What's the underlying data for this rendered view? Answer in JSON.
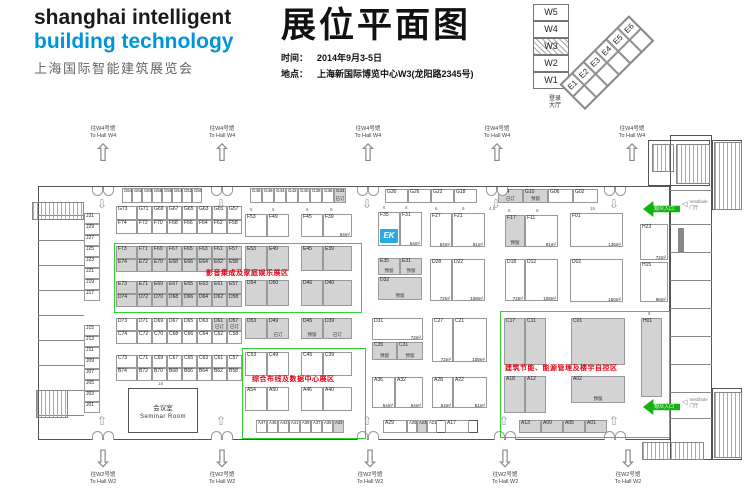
{
  "header": {
    "logo_line1": "shanghai intelligent",
    "logo_line2": "building technology",
    "logo_line3": "上海国际智能建筑展览会",
    "title": "展位平面图",
    "time_label": "时间：",
    "time_value": "2014年9月3-5日",
    "venue_label": "地点：",
    "venue_value": "上海新国际博览中心W3(龙阳路2345号)"
  },
  "colors": {
    "logo_blue": "#0095d9",
    "exhibitor_logo_blue": "#29abe2",
    "zone_green": "#2fd42f",
    "entrance_green": "#12b212",
    "zone_text_red": "#e60012",
    "booth_gray": "#d3d3d3"
  },
  "minimap": {
    "west": [
      "W5",
      "W4",
      "W3",
      "W2",
      "W1"
    ],
    "active": "W3",
    "east": [
      "E1",
      "E2",
      "E3",
      "E4",
      "E5",
      "E6"
    ],
    "lobby": {
      "line1": "登录",
      "line2": "大厅",
      "x": 549,
      "y": 96
    }
  },
  "floorplan": {
    "logo_text": "EK",
    "walls": [
      [
        38,
        186,
        632,
        254
      ],
      [
        670,
        135,
        42,
        325
      ],
      [
        648,
        140,
        62,
        46
      ],
      [
        712,
        140,
        30,
        70
      ],
      [
        712,
        388,
        30,
        72
      ],
      [
        383,
        420,
        95,
        13
      ]
    ],
    "lines": [
      [
        38,
        215,
        46,
        1
      ],
      [
        38,
        240,
        46,
        1
      ],
      [
        38,
        265,
        46,
        1
      ],
      [
        38,
        290,
        46,
        1
      ],
      [
        38,
        315,
        46,
        1
      ],
      [
        38,
        340,
        46,
        1
      ],
      [
        38,
        365,
        46,
        1
      ],
      [
        38,
        390,
        46,
        1
      ],
      [
        38,
        415,
        46,
        1
      ],
      [
        670,
        190,
        42,
        1
      ],
      [
        670,
        224,
        42,
        1
      ],
      [
        670,
        252,
        42,
        1
      ],
      [
        670,
        280,
        42,
        1
      ],
      [
        670,
        308,
        42,
        1
      ],
      [
        670,
        336,
        42,
        1
      ],
      [
        670,
        364,
        42,
        1
      ],
      [
        670,
        392,
        42,
        1
      ],
      [
        670,
        418,
        42,
        1
      ],
      [
        678,
        228,
        6,
        24
      ]
    ],
    "hatches": [
      [
        32,
        202,
        50,
        16
      ],
      [
        36,
        390,
        30,
        26
      ],
      [
        652,
        144,
        20,
        26
      ],
      [
        676,
        144,
        32,
        38
      ],
      [
        714,
        142,
        26,
        66
      ],
      [
        714,
        392,
        26,
        64
      ],
      [
        642,
        442,
        60,
        16
      ]
    ],
    "zones": [
      {
        "label": "影音集成及家庭娱乐展区",
        "x": 114,
        "y": 243,
        "w": 246,
        "h": 68,
        "tx": 206,
        "ty": 268
      },
      {
        "label": "综合布线及数据中心展区",
        "x": 242,
        "y": 348,
        "w": 122,
        "h": 89,
        "tx": 252,
        "ty": 374
      },
      {
        "label": "建筑节能、能源管理及楼宇自控区",
        "x": 500,
        "y": 311,
        "w": 168,
        "h": 125,
        "tx": 505,
        "ty": 363
      }
    ],
    "dirs": {
      "top": {
        "line1": "往W4号馆",
        "line2": "To Hall W4",
        "arrow": "⇧",
        "xs": [
          103,
          222,
          368,
          497,
          632
        ],
        "y": 126
      },
      "bottom": {
        "line1": "往W2号馆",
        "line2": "To Hall W2",
        "arrow": "⇩",
        "xs": [
          103,
          222,
          370,
          505,
          628
        ],
        "y": 446
      }
    },
    "doors": {
      "top": {
        "y": 187,
        "xs": [
          103,
          222,
          368,
          497,
          615
        ]
      },
      "bottom": {
        "y": 431,
        "xs": [
          103,
          222,
          368,
          505,
          615
        ]
      }
    },
    "inner": {
      "top": {
        "glyph": "⇩",
        "y": 197
      },
      "bottom": {
        "glyph": "⇧",
        "y": 414
      }
    },
    "entrance": {
      "label": "观众入口",
      "items": [
        {
          "x": 643,
          "y": 201
        },
        {
          "x": 643,
          "y": 399
        }
      ]
    },
    "vestibule": {
      "line1": "Vestibule",
      "line2": "门厅",
      "icon": "◁",
      "items": [
        {
          "x": 682,
          "y": 199
        },
        {
          "x": 682,
          "y": 397
        }
      ]
    },
    "seminar": {
      "cn": "会议室",
      "en": "Seminar Room",
      "x": 128,
      "y": 388,
      "w": 70,
      "h": 45
    },
    "dims": [
      [
        "6",
        250,
        207
      ],
      [
        "6",
        272,
        207
      ],
      [
        "6",
        306,
        207
      ],
      [
        "9",
        330,
        207
      ],
      [
        "6",
        383,
        205
      ],
      [
        "6",
        405,
        205
      ],
      [
        "6",
        435,
        206
      ],
      [
        "9",
        462,
        206
      ],
      [
        "4.5",
        489,
        206
      ],
      [
        "6",
        508,
        208
      ],
      [
        "9",
        536,
        208
      ],
      [
        "15",
        590,
        206
      ],
      [
        "8",
        648,
        311
      ],
      [
        "18",
        158,
        381
      ]
    ],
    "vcols": [
      {
        "x": 84,
        "w": 16,
        "h": 11,
        "y": 213,
        "step": 11,
        "ids": [
          "J31",
          "J29",
          "J27",
          "J25",
          "J23",
          "J21",
          "J19",
          "J17"
        ]
      },
      {
        "x": 84,
        "w": 16,
        "h": 11,
        "y": 325,
        "step": 11,
        "ids": [
          "J15",
          "J13",
          "J11",
          "J09",
          "J07",
          "J05",
          "J03",
          "J01"
        ]
      }
    ],
    "rows": [
      {
        "x": 122,
        "y": 188,
        "h": 15,
        "cw": 10,
        "fs": 4.2,
        "cells": [
          "G64",
          "G62",
          "G60",
          "G58",
          "G56",
          "G54",
          "G52",
          "G50"
        ]
      },
      {
        "x": 250,
        "y": 188,
        "h": 15,
        "cw": 12,
        "fs": 4.5,
        "cells": [
          "G48",
          "G46",
          "G44",
          "G42",
          "G40",
          "G38",
          "G36",
          {
            "id": "G34",
            "g": 1,
            "s": "已订"
          }
        ]
      },
      {
        "x": 385,
        "y": 189,
        "h": 14,
        "cw": 23,
        "cells": [
          "G30",
          "G26",
          "G22",
          "G18"
        ]
      },
      {
        "x": 498,
        "y": 189,
        "h": 14,
        "cw": 25,
        "cells": [
          {
            "id": "G14",
            "g": 1,
            "s": "已订"
          },
          {
            "id": "G10",
            "g": 1,
            "s": "预留"
          },
          "G06",
          "G02"
        ]
      },
      {
        "x": 116,
        "y": 206,
        "h": 14,
        "w0": 21,
        "cw": 15,
        "cells": [
          "G73",
          "G71",
          "G69",
          "G67",
          "G65",
          "G63",
          "G61",
          "G57"
        ]
      },
      {
        "x": 116,
        "y": 220,
        "h": 14,
        "w0": 21,
        "cw": 15,
        "cells": [
          "F74",
          "F72",
          "F70",
          "F68",
          "F66",
          "F64",
          "F62",
          "F58"
        ]
      },
      {
        "x": 116,
        "y": 246,
        "h": 13,
        "w0": 21,
        "cw": 15,
        "g": 1,
        "cells": [
          "F73",
          "F71",
          "F69",
          "F67",
          "F65",
          "F63",
          "F61",
          "F57"
        ]
      },
      {
        "x": 116,
        "y": 259,
        "h": 13,
        "w0": 21,
        "cw": 15,
        "g": 1,
        "cells": [
          "E74",
          "E72",
          "E70",
          "E68",
          "E66",
          "E64",
          "E62",
          "E58"
        ]
      },
      {
        "x": 116,
        "y": 281,
        "h": 13,
        "w0": 21,
        "cw": 15,
        "g": 1,
        "cells": [
          "E73",
          "E71",
          "E69",
          "E67",
          "E65",
          "E63",
          "E61",
          "E57"
        ]
      },
      {
        "x": 116,
        "y": 294,
        "h": 13,
        "w0": 21,
        "cw": 15,
        "g": 1,
        "cells": [
          "D74",
          "D72",
          "D70",
          "D68",
          "D66",
          "D64",
          "D62",
          "D58"
        ]
      },
      {
        "x": 116,
        "y": 318,
        "h": 13,
        "w0": 21,
        "cw": 15,
        "cells": [
          "D73",
          "D71",
          "D69",
          "D67",
          "D65",
          "D63",
          {
            "id": "D61",
            "g": 1,
            "s": "已订"
          },
          {
            "id": "D57",
            "g": 1,
            "s": "已订"
          }
        ]
      },
      {
        "x": 116,
        "y": 331,
        "h": 13,
        "w0": 21,
        "cw": 15,
        "cells": [
          "C74",
          "C72",
          "C70",
          "C68",
          "C66",
          "C64",
          "C62",
          "C58"
        ]
      },
      {
        "x": 116,
        "y": 355,
        "h": 13,
        "w0": 21,
        "cw": 15,
        "cells": [
          "C73",
          "C71",
          "C69",
          "C67",
          "C65",
          "C63",
          "C61",
          "C57"
        ]
      },
      {
        "x": 116,
        "y": 368,
        "h": 13,
        "w0": 21,
        "cw": 15,
        "cells": [
          "B74",
          "B72",
          "B70",
          "B68",
          "B66",
          "B64",
          "B62",
          "B58"
        ]
      },
      {
        "x": 256,
        "y": 420,
        "h": 13,
        "cw": 11,
        "fs": 4.2,
        "cells": [
          "A47",
          "A45",
          "A43",
          "A41",
          "A39",
          "A37",
          "A35",
          {
            "id": "A33",
            "g": 1
          }
        ]
      },
      {
        "x": 519,
        "y": 420,
        "h": 13,
        "cw": 22,
        "g": 1,
        "cells": [
          "A13",
          "A09",
          "A05",
          "A01"
        ]
      }
    ],
    "booths": [
      {
        "id": "F53",
        "x": 245,
        "y": 214,
        "w": 22,
        "h": 23
      },
      {
        "id": "F49",
        "x": 267,
        "y": 214,
        "w": 22,
        "h": 23
      },
      {
        "id": "F45",
        "x": 301,
        "y": 214,
        "w": 22,
        "h": 23
      },
      {
        "id": "F39",
        "x": 323,
        "y": 214,
        "w": 29,
        "h": 23,
        "a": "54m²"
      },
      {
        "id": "E53",
        "x": 245,
        "y": 246,
        "w": 22,
        "h": 25,
        "g": 1
      },
      {
        "id": "E49",
        "x": 267,
        "y": 246,
        "w": 22,
        "h": 25,
        "g": 1
      },
      {
        "id": "E45",
        "x": 301,
        "y": 246,
        "w": 22,
        "h": 25,
        "g": 1
      },
      {
        "id": "E39",
        "x": 323,
        "y": 246,
        "w": 29,
        "h": 25,
        "g": 1
      },
      {
        "id": "D54",
        "x": 245,
        "y": 280,
        "w": 22,
        "h": 26,
        "g": 1
      },
      {
        "id": "D50",
        "x": 267,
        "y": 280,
        "w": 22,
        "h": 26,
        "g": 1
      },
      {
        "id": "D46",
        "x": 301,
        "y": 280,
        "w": 22,
        "h": 26,
        "g": 1
      },
      {
        "id": "D40",
        "x": 323,
        "y": 280,
        "w": 29,
        "h": 26,
        "g": 1
      },
      {
        "id": "D53",
        "x": 245,
        "y": 318,
        "w": 22,
        "h": 21,
        "g": 1
      },
      {
        "id": "D49",
        "x": 267,
        "y": 318,
        "w": 22,
        "h": 21,
        "g": 1,
        "s": "已订"
      },
      {
        "id": "D45",
        "x": 301,
        "y": 318,
        "w": 22,
        "h": 21,
        "g": 1,
        "s": "预留"
      },
      {
        "id": "D39",
        "x": 323,
        "y": 318,
        "w": 29,
        "h": 21,
        "g": 1,
        "s": "已订"
      },
      {
        "id": "C53",
        "x": 245,
        "y": 352,
        "w": 22,
        "h": 24
      },
      {
        "id": "C49",
        "x": 267,
        "y": 352,
        "w": 22,
        "h": 24
      },
      {
        "id": "C45",
        "x": 301,
        "y": 352,
        "w": 22,
        "h": 24
      },
      {
        "id": "C39",
        "x": 323,
        "y": 352,
        "w": 29,
        "h": 24
      },
      {
        "id": "A54",
        "x": 245,
        "y": 387,
        "w": 22,
        "h": 24
      },
      {
        "id": "A50",
        "x": 267,
        "y": 387,
        "w": 22,
        "h": 24
      },
      {
        "id": "A46",
        "x": 301,
        "y": 387,
        "w": 22,
        "h": 24
      },
      {
        "id": "A40",
        "x": 323,
        "y": 387,
        "w": 29,
        "h": 24
      },
      {
        "id": "F35",
        "x": 378,
        "y": 212,
        "w": 22,
        "h": 34,
        "logo": 1
      },
      {
        "id": "F31",
        "x": 400,
        "y": 212,
        "w": 22,
        "h": 34,
        "a": "54m²"
      },
      {
        "id": "E35",
        "x": 378,
        "y": 258,
        "w": 22,
        "h": 17,
        "g": 1,
        "s": "预留"
      },
      {
        "id": "E31",
        "x": 400,
        "y": 258,
        "w": 22,
        "h": 17,
        "g": 1,
        "s": "预留"
      },
      {
        "id": "D32",
        "x": 378,
        "y": 277,
        "w": 44,
        "h": 23,
        "g": 1,
        "s": "预留"
      },
      {
        "id": "F27",
        "x": 430,
        "y": 213,
        "w": 22,
        "h": 34,
        "a": "54m²"
      },
      {
        "id": "F21",
        "x": 452,
        "y": 213,
        "w": 33,
        "h": 34,
        "a": "81m²"
      },
      {
        "id": "D28",
        "x": 430,
        "y": 259,
        "w": 22,
        "h": 42,
        "a": "72m²"
      },
      {
        "id": "D22",
        "x": 452,
        "y": 259,
        "w": 33,
        "h": 42,
        "a": "108m²"
      },
      {
        "id": "F17",
        "x": 505,
        "y": 215,
        "w": 20,
        "h": 32,
        "g": 1,
        "s": "预留"
      },
      {
        "id": "F11",
        "x": 525,
        "y": 215,
        "w": 33,
        "h": 32,
        "a": "81m²"
      },
      {
        "id": "D18",
        "x": 505,
        "y": 259,
        "w": 20,
        "h": 42,
        "a": "72m²"
      },
      {
        "id": "D12",
        "x": 525,
        "y": 259,
        "w": 33,
        "h": 42,
        "a": "108m²"
      },
      {
        "id": "F01",
        "x": 570,
        "y": 213,
        "w": 53,
        "h": 34,
        "a": "135m²"
      },
      {
        "id": "D02",
        "x": 570,
        "y": 259,
        "w": 53,
        "h": 43,
        "a": "160m²"
      },
      {
        "id": "H23",
        "x": 640,
        "y": 224,
        "w": 28,
        "h": 36,
        "a": "72m²"
      },
      {
        "id": "H15",
        "x": 640,
        "y": 262,
        "w": 28,
        "h": 40,
        "a": "96m²"
      },
      {
        "id": "H01",
        "x": 641,
        "y": 318,
        "w": 21,
        "h": 79,
        "g": 1
      },
      {
        "id": "D31",
        "x": 372,
        "y": 318,
        "w": 51,
        "h": 22,
        "a": "72m²"
      },
      {
        "id": "C35",
        "x": 372,
        "y": 342,
        "w": 25,
        "h": 18,
        "g": 1,
        "s": "预留"
      },
      {
        "id": "C31",
        "x": 397,
        "y": 342,
        "w": 26,
        "h": 18,
        "g": 1,
        "s": "预留"
      },
      {
        "id": "C27",
        "x": 432,
        "y": 318,
        "w": 21,
        "h": 44,
        "a": "72m²"
      },
      {
        "id": "C21",
        "x": 453,
        "y": 318,
        "w": 34,
        "h": 44,
        "a": "108m²"
      },
      {
        "id": "A36",
        "x": 372,
        "y": 377,
        "w": 23,
        "h": 31,
        "a": "54m²"
      },
      {
        "id": "A32",
        "x": 395,
        "y": 377,
        "w": 28,
        "h": 31,
        "a": "54m²"
      },
      {
        "id": "A28",
        "x": 432,
        "y": 377,
        "w": 21,
        "h": 31,
        "a": "54m²"
      },
      {
        "id": "A22",
        "x": 453,
        "y": 377,
        "w": 34,
        "h": 31,
        "a": "81m²"
      },
      {
        "id": "C17",
        "x": 504,
        "y": 318,
        "w": 21,
        "h": 47,
        "g": 1
      },
      {
        "id": "C11",
        "x": 525,
        "y": 318,
        "w": 21,
        "h": 47,
        "g": 1
      },
      {
        "id": "C01",
        "x": 571,
        "y": 318,
        "w": 54,
        "h": 47,
        "g": 1
      },
      {
        "id": "A18",
        "x": 504,
        "y": 376,
        "w": 21,
        "h": 37,
        "g": 1
      },
      {
        "id": "A12",
        "x": 525,
        "y": 376,
        "w": 21,
        "h": 37,
        "g": 1
      },
      {
        "id": "A02",
        "x": 571,
        "y": 376,
        "w": 54,
        "h": 27,
        "g": 1,
        "s": "预留"
      },
      {
        "id": "A29",
        "x": 383,
        "y": 420,
        "w": 24,
        "h": 13
      },
      {
        "id": "A25",
        "x": 407,
        "y": 420,
        "w": 10,
        "h": 13,
        "fs": 4.2
      },
      {
        "id": "A23",
        "x": 417,
        "y": 420,
        "w": 10,
        "h": 13,
        "g": 1,
        "fs": 4.2
      },
      {
        "id": "A21",
        "x": 427,
        "y": 420,
        "w": 10,
        "h": 13,
        "fs": 4.2
      },
      {
        "id": "A17",
        "x": 445,
        "y": 420,
        "w": 24,
        "h": 13
      }
    ]
  }
}
